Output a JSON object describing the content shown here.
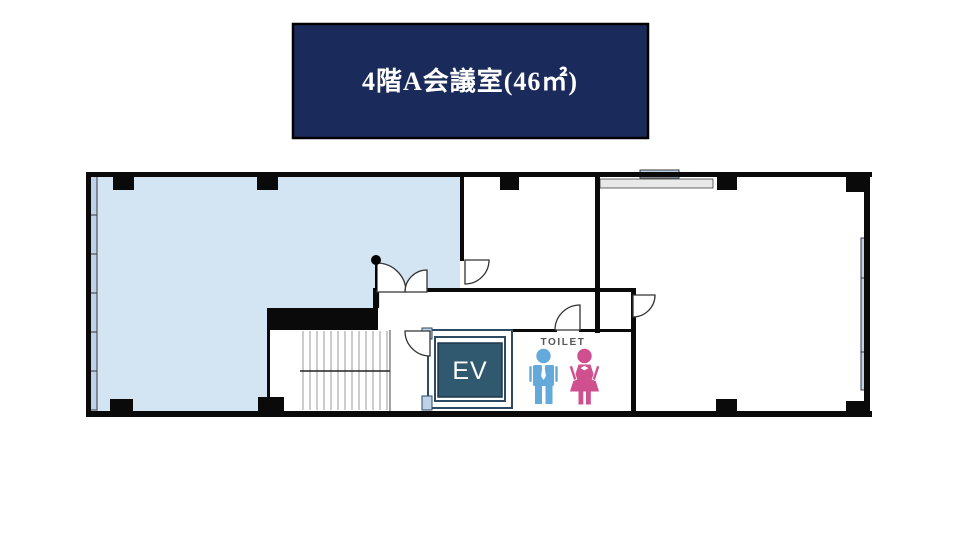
{
  "banner": {
    "title": "4階A会議室(46㎡)"
  },
  "plan": {
    "elevator_label": "EV",
    "toilet_label": "TOILET"
  },
  "icons": {
    "male": "male-restroom-icon",
    "female": "female-restroom-icon"
  },
  "colors": {
    "banner_bg": "#1a2a5a",
    "banner_text": "#ffffff",
    "room_highlight": "#d3e5f3",
    "window": "#bed3e9",
    "wall": "#0a0a0a",
    "elevator": "#30586f",
    "elevator_text": "#ffffff",
    "counter_gray": "#e9e9e9",
    "toilet_text": "#555555",
    "male_icon": "#64a9db",
    "female_icon": "#d0508f"
  }
}
